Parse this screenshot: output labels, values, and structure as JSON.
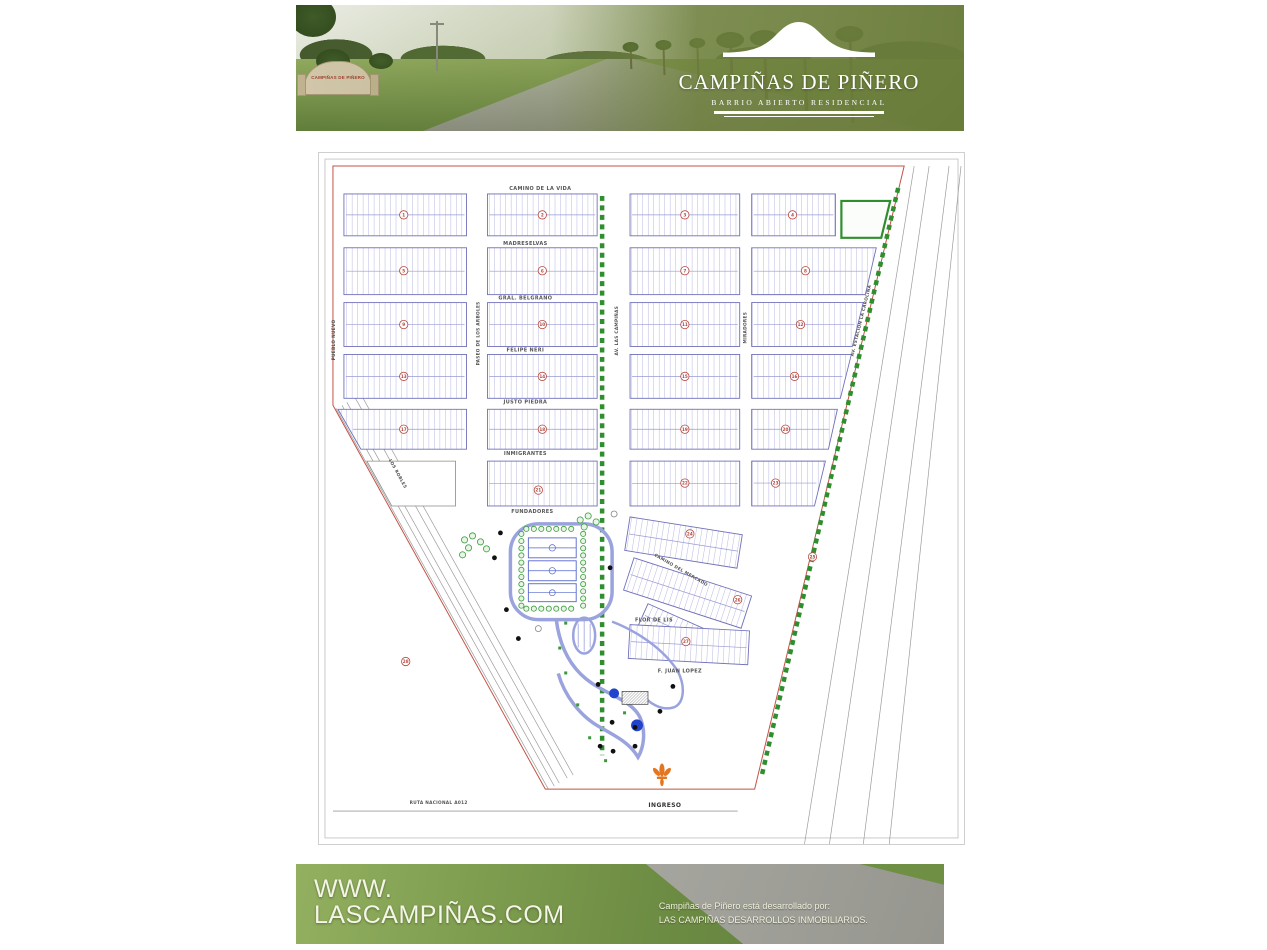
{
  "header": {
    "title": "CAMPIÑAS DE PIÑERO",
    "subtitle": "BARRIO ABIERTO RESIDENCIAL",
    "entrance_sign_text": "CAMPIÑAS DE PIÑERO"
  },
  "footer": {
    "website_line1": "WWW.",
    "website_line2": "LASCAMPIÑAS.COM",
    "developer_line1": "Campiñas de Piñero está desarrollado por:",
    "developer_line2": "LAS CAMPIÑAS DESARROLLOS INMOBILIARIOS."
  },
  "map": {
    "streets": {
      "camino_de_la_vida": "CAMINO DE LA VIDA",
      "madreselvas": "MADRESELVAS",
      "gral_belgrano": "GRAL. BELGRANO",
      "felipe_neri": "FELIPE NERI",
      "justo_piedra": "JUSTO PIEDRA",
      "inmigrantes": "INMIGRANTES",
      "fundadores": "FUNDADORES",
      "camino_del_mercado": "CAMINO DEL MERCADO",
      "flor_de_lis": "FLOR DE LIS",
      "f_juan_lopez": "F. JUAN LOPEZ",
      "pueblo_nuevo": "PUEBLO NUEVO",
      "paseo_de_los_arboles": "PASEO DE LOS ARBOLES",
      "av_las_campinas": "AV. LAS CAMPIÑAS",
      "miradores": "MIRADORES",
      "av_estacion": "AV. ESTACION LA CAROLINA",
      "los_robles": "LOS ROBLES",
      "ruta_nacional": "RUTA NACIONAL A012",
      "ingreso": "INGRESO"
    },
    "block_numbers": [
      "1",
      "2",
      "3",
      "4",
      "5",
      "6",
      "7",
      "8",
      "9",
      "10",
      "11",
      "12",
      "13",
      "14",
      "15",
      "16",
      "17",
      "18",
      "19",
      "20",
      "21",
      "22",
      "23",
      "24",
      "25",
      "26",
      "27",
      "28"
    ],
    "colors": {
      "lot_lines": "#9a9ad6",
      "block_border": "#7070bb",
      "boundary_line": "#c45246",
      "tree_green": "#2f8f2f",
      "marker_red": "#b5453a",
      "entrance_orange": "#e5761e",
      "park_path": "#9aa3dd",
      "pond_blue": "#2244cc"
    }
  }
}
